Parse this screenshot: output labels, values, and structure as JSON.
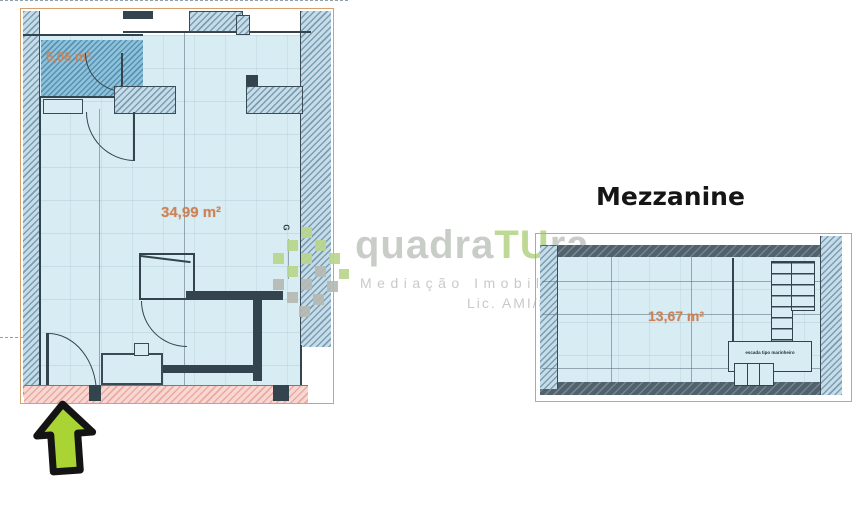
{
  "titles": {
    "mezzanine": "Mezzanine"
  },
  "watermark": {
    "brand_part1": "quadra",
    "brand_part2": "TU",
    "brand_part3": "ra",
    "tagline": "Mediação Imobiliária",
    "license": "Lic. AMI/8478"
  },
  "main_plan": {
    "area_label": "34,99 m²",
    "small_room_area_label": "5,06 m²",
    "gas_mark": "G"
  },
  "mezzanine_plan": {
    "area_label": "13,67 m²",
    "stairs_label": "escada tipo marinheiro"
  },
  "arrow": {
    "direction": "up"
  },
  "colors": {
    "area_text": "#cd8256",
    "watermark_gray": "#c5c9c3",
    "watermark_green": "#b9d68d",
    "arrow_fill": "#a9d434",
    "wall_dark": "#33444f",
    "wall_hatch_bg": "#c6dde9",
    "interior_bg": "#d8edf3",
    "pink_strip_bg": "#f6d7d1",
    "outline_tan": "#d4a06e"
  }
}
